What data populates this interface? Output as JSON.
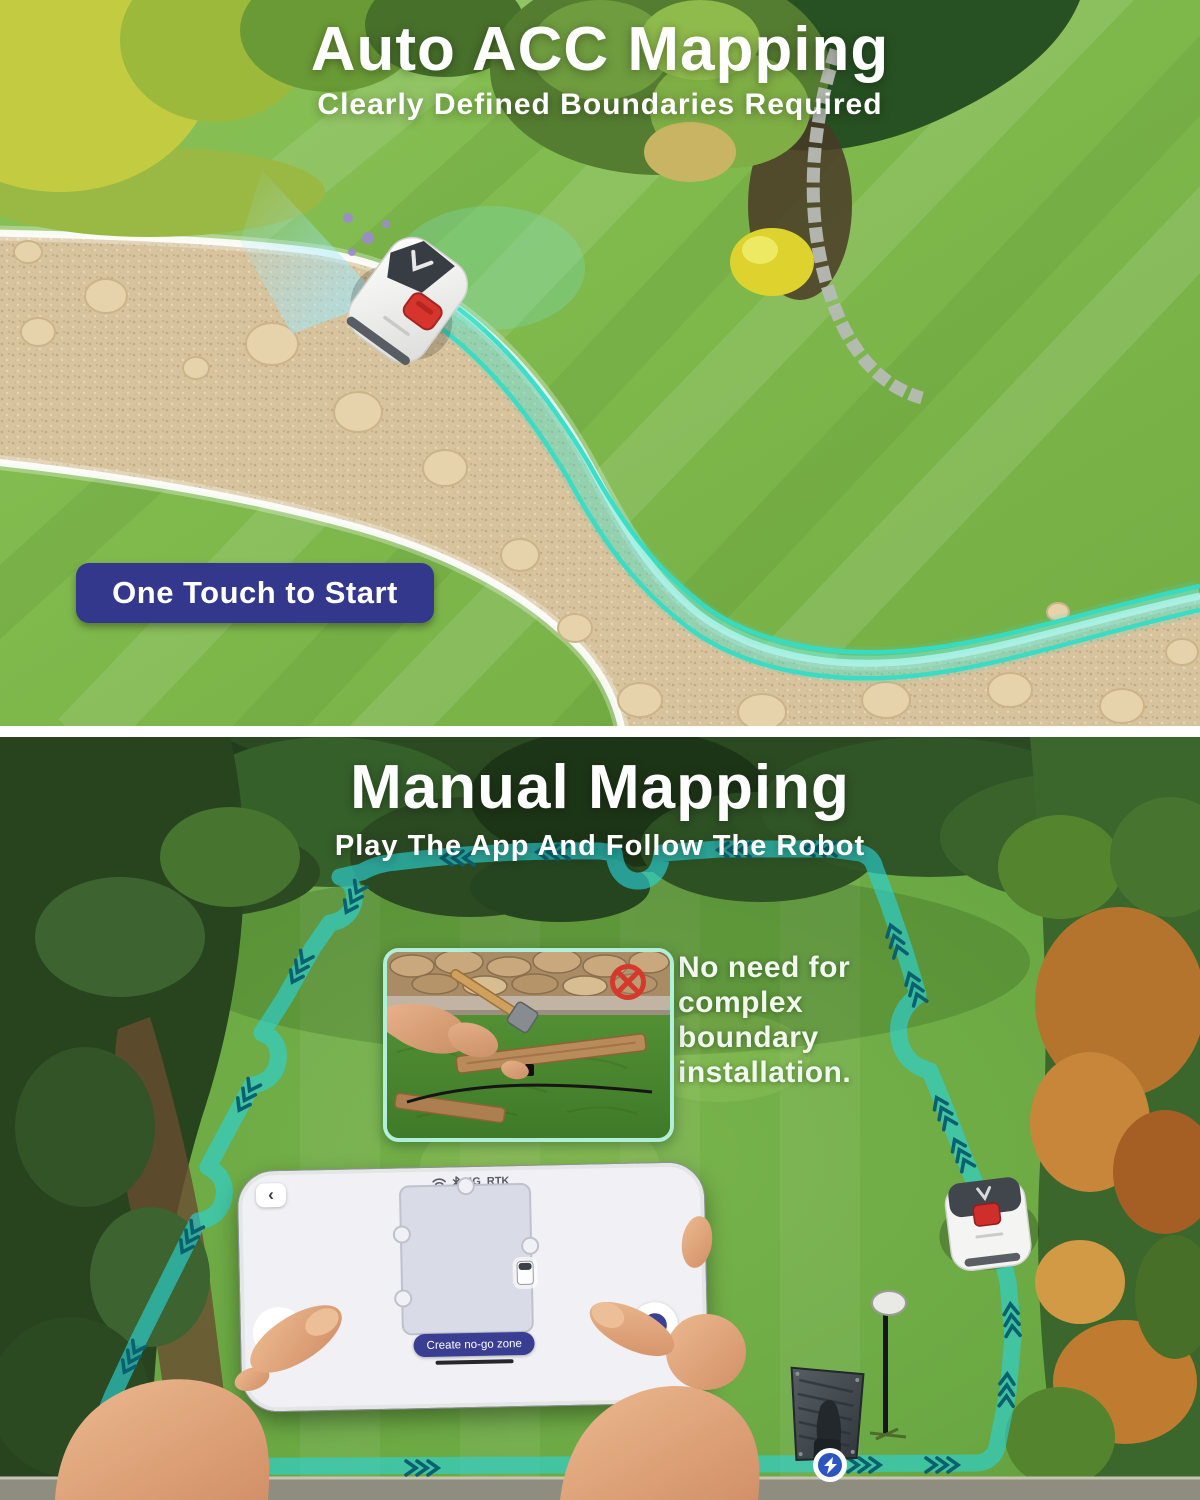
{
  "section1": {
    "title": "Auto ACC Mapping",
    "subtitle": "Clearly Defined Boundaries Required",
    "badge_label": "One Touch to Start"
  },
  "section2": {
    "title": "Manual Mapping",
    "subtitle": "Play The App And Follow The Robot",
    "callout_lines": [
      "No need for",
      "complex",
      "boundary",
      "installation."
    ]
  },
  "phone": {
    "back_glyph": "‹",
    "status": {
      "network": "4G",
      "mode": "RTK"
    },
    "button_label": "Create no-go zone",
    "dots_glyph": "⋯"
  },
  "icons": {
    "wifi": "wifi-icon",
    "bluetooth": "bluetooth-icon",
    "prohibition": "no-boundary-wire-icon",
    "lightning": "charging-station-icon"
  },
  "colors": {
    "accent_teal": "#2bd5d8",
    "badge_navy": "#33388c",
    "button_navy": "#393e93",
    "alert_red": "#d5392b",
    "lawn_green": "#7eb84b"
  }
}
